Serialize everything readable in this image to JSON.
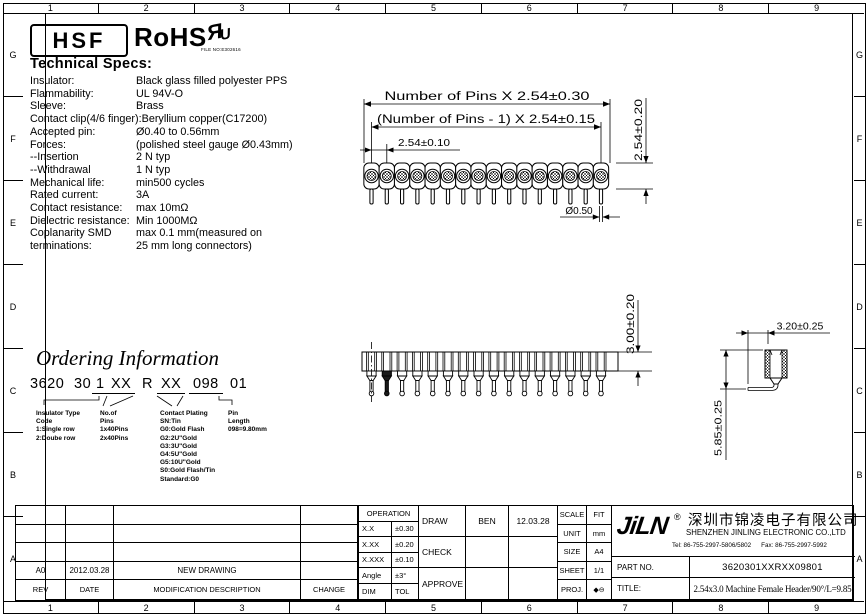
{
  "colors": {
    "ink": "#000000",
    "paper": "#ffffff"
  },
  "frame": {
    "column_labels": [
      "1",
      "2",
      "3",
      "4",
      "5",
      "6",
      "7",
      "8",
      "9"
    ],
    "row_labels": [
      "G",
      "F",
      "E",
      "D",
      "C",
      "B",
      "A"
    ]
  },
  "header_logos": {
    "hsf": "HSF",
    "rohs": "RoHS",
    "ul_r": "Я",
    "ul_u": "U",
    "ul_file_no": "FILE NO:E302616"
  },
  "tech_specs": {
    "heading": "Technical Specs:",
    "items": [
      {
        "label": "Insulator:",
        "value": "Black glass filled polyester PPS"
      },
      {
        "label": "Flammability:",
        "value": "UL 94V-O"
      },
      {
        "label": "Sleeve:",
        "value": "Brass"
      },
      {
        "label": "Contact clip(4/6 finger):",
        "value": "Beryllium copper(C17200)"
      },
      {
        "label": "Accepted pin:",
        "value": "Ø0.40 to 0.56mm"
      },
      {
        "label": "Forces:",
        "value": "(polished steel gauge Ø0.43mm)"
      },
      {
        "label": "--Insertion",
        "value": "2 N typ"
      },
      {
        "label": "--Withdrawal",
        "value": "1 N typ"
      },
      {
        "label": "Mechanical life:",
        "value": "min500 cycles"
      },
      {
        "label": "Rated current:",
        "value": "3A"
      },
      {
        "label": "Contact resistance:",
        "value": "max 10mΩ"
      },
      {
        "label": "Dielectric resistance:",
        "value": "Min 1000MΩ"
      },
      {
        "label": "Coplanarity SMD",
        "value": "max 0.1 mm(measured on"
      },
      {
        "label": "terminations:",
        "value": "25 mm long connectors)"
      }
    ]
  },
  "drawings": {
    "pin_count": 16,
    "top_view": {
      "dim_total_width": "Number of Pins X 2.54±0.30",
      "dim_center_spacing": "(Number of Pins - 1) X 2.54±0.15",
      "dim_pitch": "2.54±0.10",
      "dim_row_width": "2.54±0.20",
      "dim_pin_diameter": "Ø0.50"
    },
    "side_view": {
      "dim_insulator_height": "3.00±0.20"
    },
    "end_view": {
      "dim_width": "3.20±0.25",
      "dim_overall_height": "5.85±0.25"
    }
  },
  "ordering": {
    "title": "Ordering Information",
    "code_segments": [
      {
        "text": "3620",
        "underline": false
      },
      {
        "text": "30",
        "underline": false
      },
      {
        "text": "1",
        "underline": true
      },
      {
        "text": "XX",
        "underline": true
      },
      {
        "text": "R",
        "underline": false
      },
      {
        "text": "XX",
        "underline": true
      },
      {
        "text": "098",
        "underline": true
      },
      {
        "text": "01",
        "underline": false
      }
    ],
    "legend_columns": [
      {
        "lines": [
          "Insulator Type",
          "Code",
          "1:Single row",
          "2:Doube row"
        ]
      },
      {
        "lines": [
          "No.of",
          "Pins",
          "1x40Pins",
          "2x40Pins"
        ]
      },
      {
        "lines": [
          "Contact Plating",
          "SN:Tin",
          "G0:Gold Flash",
          "G2:2U\"Gold",
          "G3:3U\"Gold",
          "G4:5U\"Gold",
          "G5:10U\"Gold",
          "S0:Gold Flash/Tin",
          "Standard:G0"
        ]
      },
      {
        "lines": [
          "Pin",
          "Length",
          "098=9.80mm"
        ]
      }
    ]
  },
  "revision_table": {
    "headers": [
      "REV",
      "DATE",
      "MODIFICATION DESCRIPTION",
      "CHANGE"
    ],
    "rows": [
      [
        "",
        "",
        "",
        ""
      ],
      [
        "",
        "",
        "",
        ""
      ],
      [
        "",
        "",
        "",
        ""
      ],
      [
        "A0",
        "2012.03.28",
        "NEW DRAWING",
        ""
      ]
    ]
  },
  "tolerance_table": {
    "title": "OPERATION",
    "rows": [
      [
        "X.X",
        "±0.30"
      ],
      [
        "X.XX",
        "±0.20"
      ],
      [
        "X.XXX",
        "±0.10"
      ],
      [
        "Angle",
        "±3°"
      ],
      [
        "DIM",
        "TOL"
      ]
    ]
  },
  "approval_table": {
    "rows": [
      [
        "DRAW",
        "BEN",
        "12.03.28"
      ],
      [
        "CHECK",
        "",
        ""
      ],
      [
        "APPROVE",
        "",
        ""
      ]
    ]
  },
  "sheet_info": {
    "rows": [
      [
        "SCALE",
        "FIT"
      ],
      [
        "UNIT",
        "mm"
      ],
      [
        "SIZE",
        "A4"
      ],
      [
        "SHEET",
        "1/1"
      ],
      [
        "PROJ.",
        "◆⊖"
      ]
    ]
  },
  "title_block": {
    "logo": "JiLN",
    "registered_mark": "®",
    "company_cn": "深圳市锦凌电子有限公司",
    "company_en": "SHENZHEN JINLING ELECTRONIC CO.,LTD",
    "tel": "Tel: 86-755-2997-5806/5802",
    "fax": "Fax: 86-755-2997-5992",
    "part_no_label": "PART NO.",
    "part_no": "3620301XXRXX09801",
    "title_label": "TITLE:",
    "drawing_title": "2.54x3.0 Machine Female Header/90°/L=9.85"
  }
}
